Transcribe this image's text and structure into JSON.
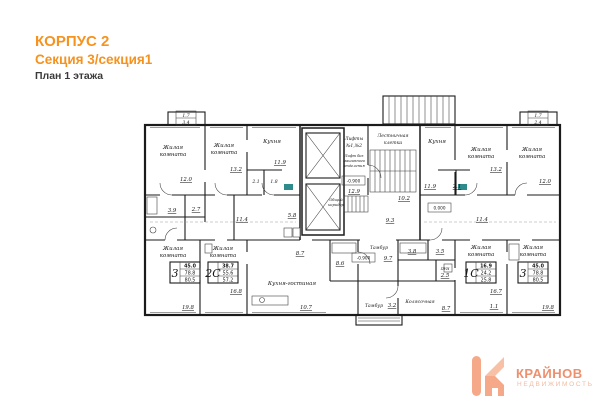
{
  "header": {
    "line1": "КОРПУС 2",
    "line2": "Секция 3/секция1",
    "line3": "План 1 этажа"
  },
  "colors": {
    "accent_orange": "#F6921E",
    "plan_line": "#1b1b1b",
    "logo_primary": "#EE8F6D",
    "logo_secondary": "#F3BBA1",
    "logo_icon": "#F5A988"
  },
  "plan": {
    "room_label": {
      "l1": "Жилая",
      "l2": "комната"
    },
    "kitchen_label": "Кухня",
    "kitchen_living_label": "Кухня-гостиная",
    "stair_label": {
      "l1": "Лестничная",
      "l2": "клетка"
    },
    "lift_label": {
      "l1": "Лифты",
      "l2": "№1,№2"
    },
    "lift_note": {
      "l1": "Лифт без",
      "l2": "машинного",
      "l3": "отделения"
    },
    "corridor_label": {
      "l1": "Общий",
      "l2": "коридор"
    },
    "tambour_label": "Тамбур",
    "stroller_label": "Колясочная",
    "pui_label": "ПУИ",
    "levels": {
      "lobby": "-0.900",
      "corridor": "0.000",
      "tambour": "-0.900"
    },
    "dims": [
      "1.7",
      "3.4",
      "12.0",
      "13.2",
      "11.9",
      "2.1",
      "1.8",
      "12.9",
      "10.2",
      "11.9",
      "13.2",
      "12.0",
      "1.7",
      "2.4",
      "3.9",
      "2.7",
      "11.4",
      "5.8",
      "9.3",
      "3.8",
      "3.5",
      "2.5",
      "11.4",
      "2.1",
      "19.8",
      "16.8",
      "10.7",
      "8.7",
      "9.7",
      "3.2",
      "8.6",
      "8.7",
      "16.7",
      "1.1",
      "19.8"
    ],
    "stamps": [
      {
        "type": "3",
        "v1": "45.0",
        "v2": "78.8",
        "v3": "80.5"
      },
      {
        "type": "2С",
        "v1": "38.7",
        "v2": "55.6",
        "v3": "57.2"
      },
      {
        "type": "1С",
        "v1": "16.9",
        "v2": "24.2",
        "v3": "25.8"
      },
      {
        "type": "3",
        "v1": "45.0",
        "v2": "78.8",
        "v3": "80.5"
      }
    ]
  },
  "logo": {
    "name": "КРАЙНОВ",
    "subtitle": "НЕДВИЖИМОСТЬ"
  }
}
